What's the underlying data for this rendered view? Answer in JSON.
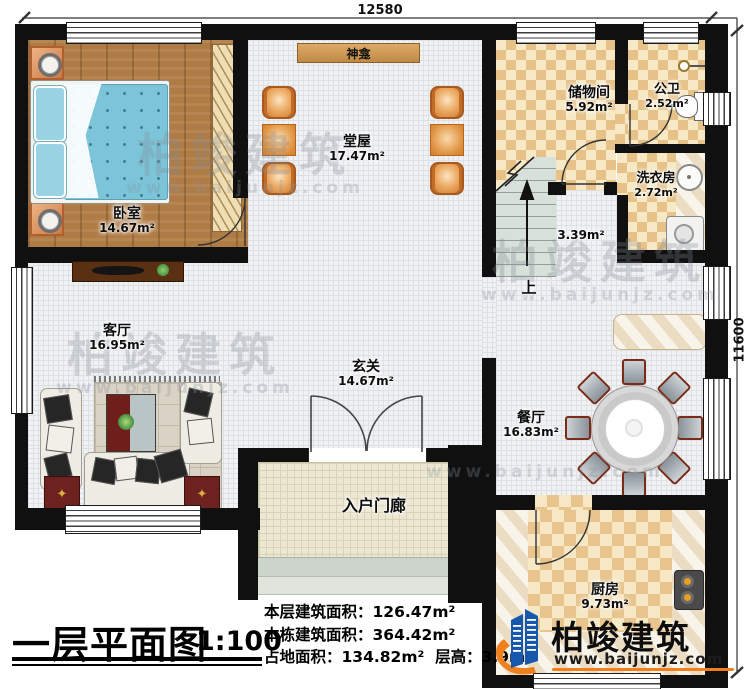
{
  "plan": {
    "dimensions": {
      "top": "12580",
      "right": "11600"
    },
    "rooms": {
      "bedroom": {
        "name": "卧室",
        "area": "14.67m²"
      },
      "hall": {
        "name": "堂屋",
        "area": "17.47m²"
      },
      "shrine": {
        "name": "神龛"
      },
      "storage": {
        "name": "储物间",
        "area": "5.92m²"
      },
      "bath": {
        "name": "公卫",
        "area": "2.52m²"
      },
      "laundry": {
        "name": "洗衣房",
        "area": "2.72m²"
      },
      "stairs": {
        "area": "3.39m²",
        "up_label": "上"
      },
      "foyer": {
        "name": "玄关",
        "area": "14.67m²"
      },
      "living": {
        "name": "客厅",
        "area": "16.95m²"
      },
      "dining": {
        "name": "餐厅",
        "area": "16.83m²"
      },
      "kitchen": {
        "name": "厨房",
        "area": "9.73m²"
      },
      "porch": {
        "name": "入户门廊"
      }
    }
  },
  "titleblock": {
    "title": "一层平面图",
    "scale": "1:100",
    "stats": [
      {
        "label": "本层建筑面积：",
        "value": "126.47m²"
      },
      {
        "label": "本栋建筑面积：",
        "value": "364.42m²"
      },
      {
        "label": "占地面积：",
        "value": "134.82m²",
        "label2": "层高：",
        "value2": "3.9m"
      }
    ]
  },
  "brand": {
    "name": "柏竣建筑",
    "website": "www.baijunjz.com"
  },
  "watermark": {
    "name": "柏竣建筑",
    "website": "www.baijunjz.com"
  },
  "colors": {
    "wall": "#101010",
    "brand_blue": "#1558ad",
    "brand_orange": "#f07f1e",
    "checker_dark": "#e6c289",
    "wood": "#b07c45",
    "mattress_blue": "#7cc4d8"
  }
}
